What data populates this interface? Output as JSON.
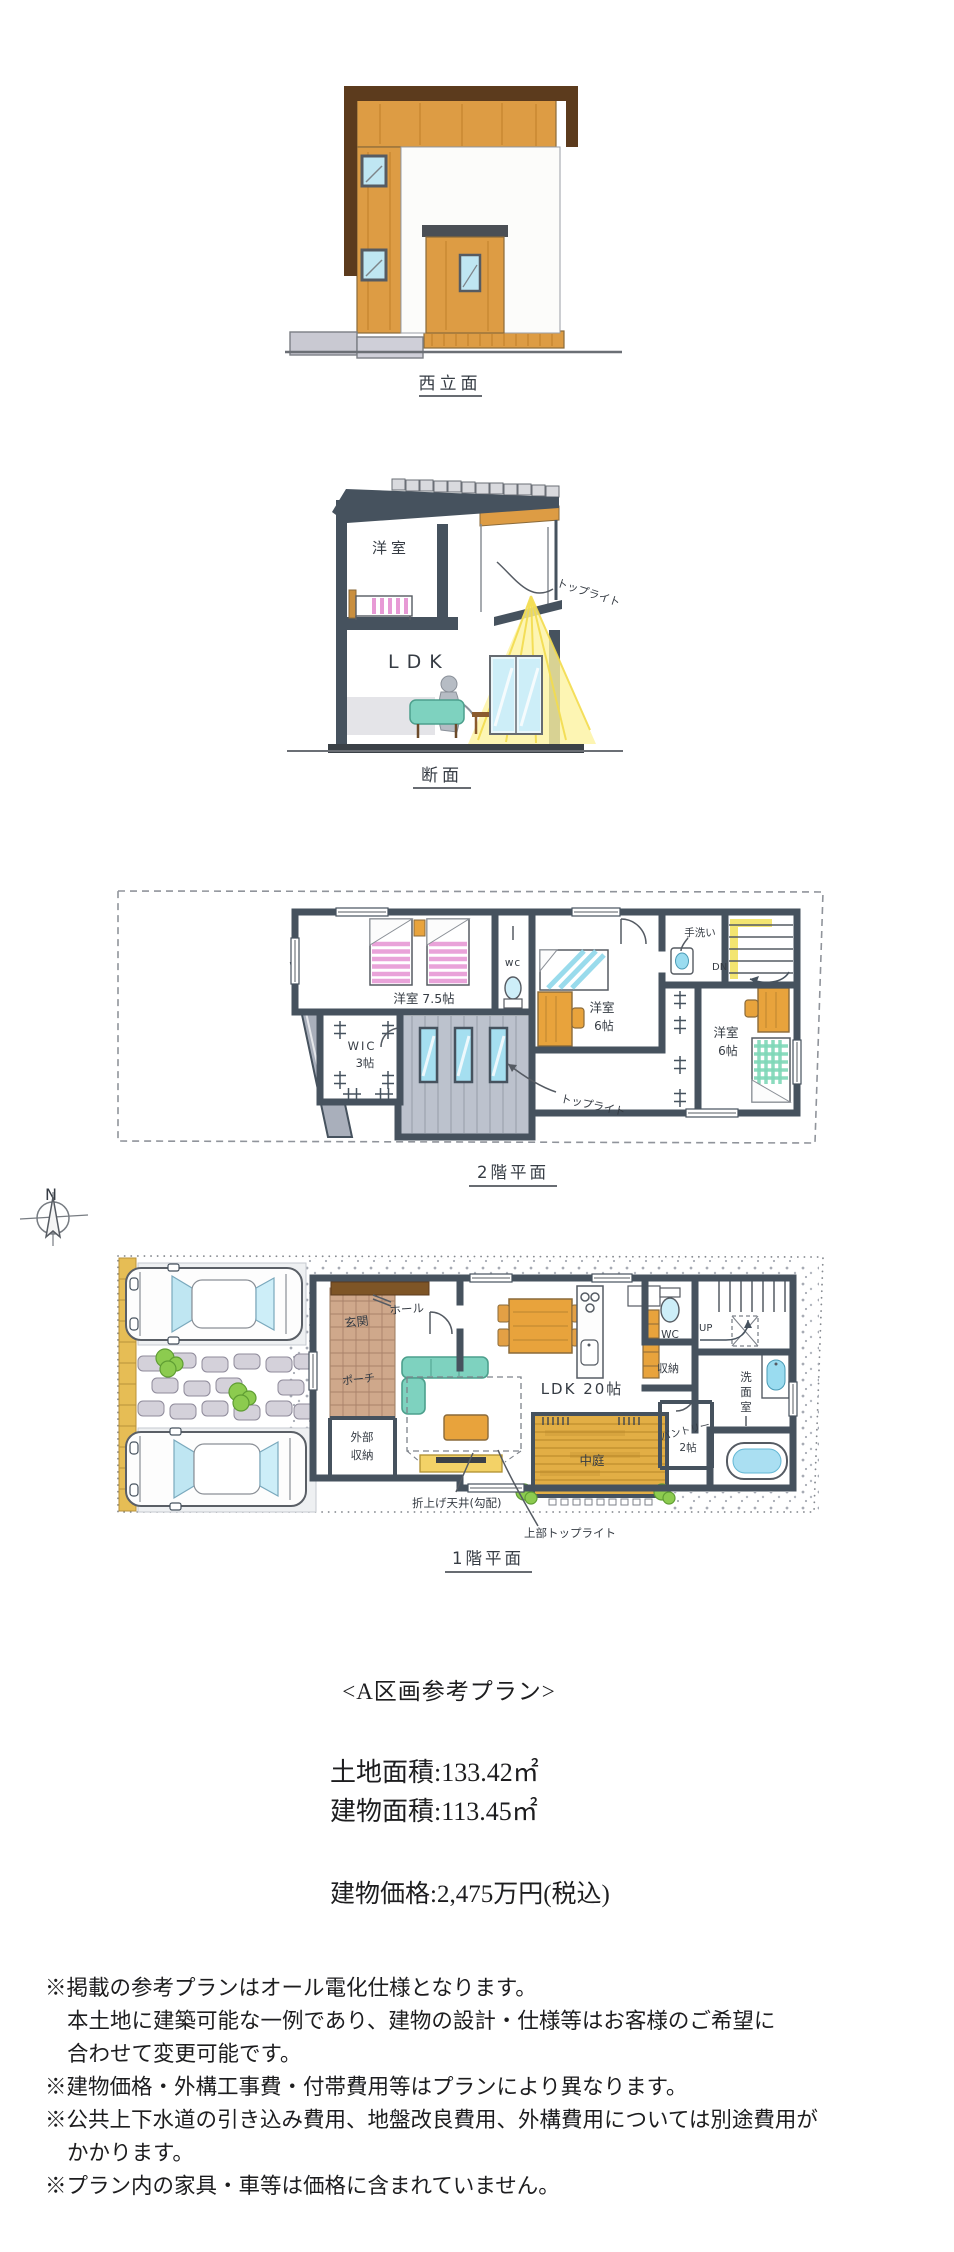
{
  "palette": {
    "wood_facade": "#dd9c44",
    "wood_dark": "#5c3b1d",
    "wall_ink": "#46525e",
    "window_blue": "#aadff2",
    "bed_pink": "#e79ad5",
    "bed_blue": "#8fd8ea",
    "bed_green": "#7fd8b8",
    "sofa_teal": "#7ed2bf",
    "deck_amber": "#e2ae45",
    "light_yellow": "#fdf2a0",
    "stair_yellow": "#f2e261",
    "bush_green": "#8ccb4f",
    "stone_yellow": "#e6bd55"
  },
  "elevation": {
    "caption": "西立面"
  },
  "section": {
    "caption": "断面",
    "room_2f": "洋室",
    "room_1f": "LDK",
    "skylight": "トップライト"
  },
  "floor2": {
    "caption": "2階平面",
    "main_room": "洋室 7.5帖",
    "wic": "WIC",
    "wic_size": "3帖",
    "wc": "wc",
    "handwash": "手洗い",
    "down": "DN",
    "room_b": "洋室",
    "room_b_size": "6帖",
    "room_c": "洋室",
    "room_c_size": "6帖",
    "skylight": "トップライト"
  },
  "compass": {
    "north": "N"
  },
  "floor1": {
    "caption": "1階平面",
    "entrance": "玄関",
    "hall": "ホール",
    "porch": "ポーチ",
    "ext_storage_1": "外部",
    "ext_storage_2": "収納",
    "ldk": "LDK 20帖",
    "courtyard": "中庭",
    "pantry": "パントリー",
    "pantry_size": "2帖",
    "wc": "WC",
    "up": "UP",
    "storage": "収納",
    "washroom": "洗面室",
    "ceiling_note": "折上げ天井(勾配)",
    "skylight_note": "上部トップライト"
  },
  "summary": {
    "plan_title": "<A区画参考プラン>",
    "land_area": "土地面積:133.42㎡",
    "building_area": "建物面積:113.45㎡",
    "price": "建物価格:2,475万円(税込)"
  },
  "notes": {
    "lines": [
      "※掲載の参考プランはオール電化仕様となります。",
      "本土地に建築可能な一例であり、建物の設計・仕様等はお客様のご希望に",
      "合わせて変更可能です。",
      "※建物価格・外構工事費・付帯費用等はプランにより異なります。",
      "※公共上下水道の引き込み費用、地盤改良費用、外構費用については別途費用が",
      "かかります。",
      "※プラン内の家具・車等は価格に含まれていません。"
    ]
  }
}
